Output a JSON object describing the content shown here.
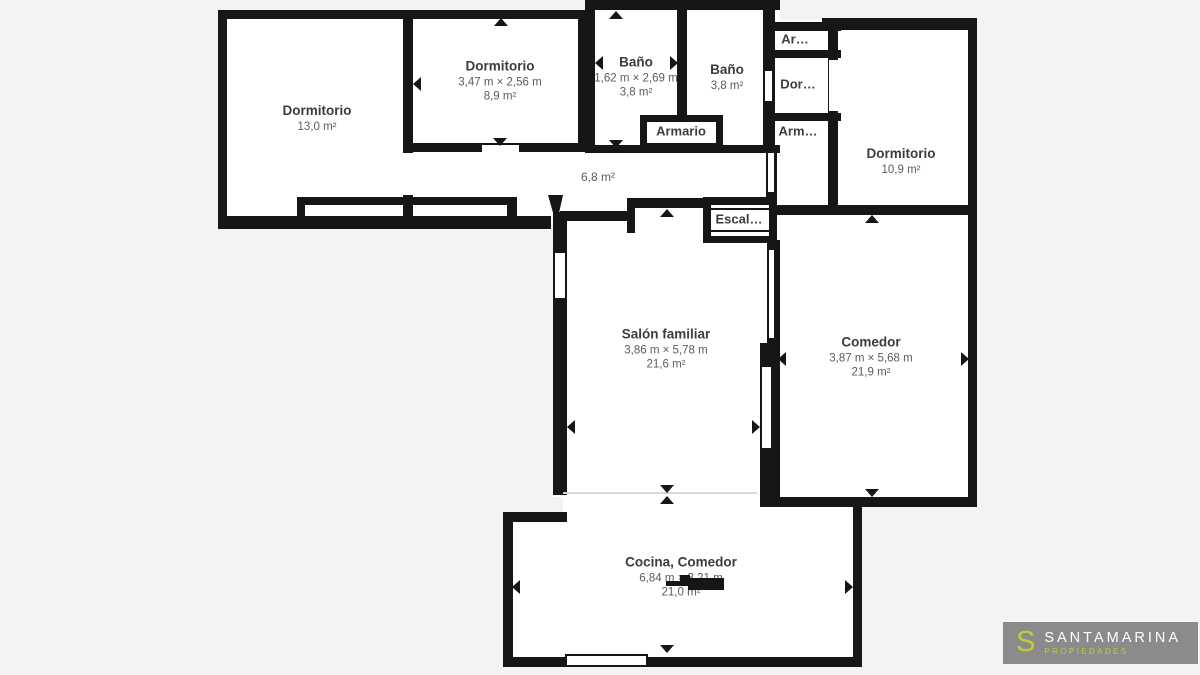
{
  "colors": {
    "background": "#f4f3f3",
    "wall": "#161616",
    "floor": "#ffffff",
    "label_dark": "#3d3d3d",
    "label_gray": "#5c5c5c",
    "logo_background": "#8b8b8b",
    "logo_accent": "#c3cc31",
    "logo_text": "#ffffff"
  },
  "rooms": {
    "dormitorio_13": {
      "name": "Dormitorio",
      "area": "13,0 m²"
    },
    "dormitorio_89": {
      "name": "Dormitorio",
      "dims": "3,47 m × 2,56 m",
      "area": "8,9 m²"
    },
    "bano_1": {
      "name": "Baño",
      "dims": "1,62 m × 2,69 m",
      "area": "3,8 m²"
    },
    "bano_2": {
      "name": "Baño",
      "area": "3,8 m²"
    },
    "armario": {
      "name": "Armario"
    },
    "armario_top": {
      "name": "Ar…"
    },
    "dormitorio_small": {
      "name": "Dor…"
    },
    "armario_bottom": {
      "name": "Arm…"
    },
    "dormitorio_109": {
      "name": "Dormitorio",
      "area": "10,9 m²"
    },
    "pasillo": {
      "area": "6,8 m²"
    },
    "escalera": {
      "name": "Escal…"
    },
    "salon": {
      "name": "Salón familiar",
      "dims": "3,86 m × 5,78 m",
      "area": "21,6 m²"
    },
    "comedor": {
      "name": "Comedor",
      "dims": "3,87 m × 5,68 m",
      "area": "21,9 m²"
    },
    "cocina": {
      "name": "Cocina, Comedor",
      "dims": "6,84 m × 3,21 m",
      "area": "21,0 m²"
    }
  },
  "logo": {
    "monogram": "S",
    "brand": "SANTAMARINA",
    "tagline": "PROPIEDADES"
  }
}
